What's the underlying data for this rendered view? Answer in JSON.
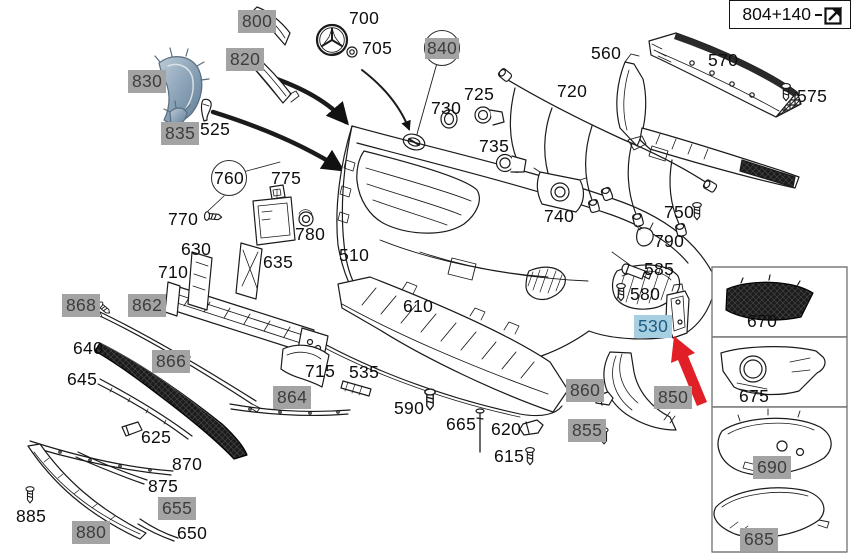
{
  "diagram": {
    "title_ref": "Front bumper exploded parts diagram",
    "ref_box": {
      "label": "804+140",
      "icon": "external-link-icon"
    },
    "selection": {
      "selected_part": "530",
      "annotation": "red-arrow-pointing-to-530"
    },
    "colors": {
      "muted_bg": "#a3a3a3",
      "muted_fg": "#3d3d3d",
      "selected_bg": "#a6cfe2",
      "selected_fg": "#1d5b7f",
      "arrow_red": "#e01f26",
      "line": "#1b1b1b"
    },
    "callouts": [
      {
        "text": "800",
        "style": "muted",
        "x": 238,
        "y": 10
      },
      {
        "text": "820",
        "style": "muted",
        "x": 226,
        "y": 48
      },
      {
        "text": "830",
        "style": "muted",
        "x": 128,
        "y": 70
      },
      {
        "text": "835",
        "style": "muted",
        "x": 161,
        "y": 122
      },
      {
        "text": "525",
        "style": "plain",
        "x": 200,
        "y": 119
      },
      {
        "text": "700",
        "style": "plain",
        "x": 349,
        "y": 8
      },
      {
        "text": "705",
        "style": "plain",
        "x": 362,
        "y": 38
      },
      {
        "text": "840",
        "style": "circle-muted",
        "x": 424,
        "y": 30
      },
      {
        "text": "730",
        "style": "plain",
        "x": 431,
        "y": 98
      },
      {
        "text": "725",
        "style": "plain",
        "x": 464,
        "y": 84
      },
      {
        "text": "735",
        "style": "plain",
        "x": 479,
        "y": 136
      },
      {
        "text": "720",
        "style": "plain",
        "x": 557,
        "y": 81
      },
      {
        "text": "560",
        "style": "plain",
        "x": 591,
        "y": 43
      },
      {
        "text": "570",
        "style": "plain",
        "x": 708,
        "y": 50
      },
      {
        "text": "575",
        "style": "plain",
        "x": 797,
        "y": 86
      },
      {
        "text": "740",
        "style": "plain",
        "x": 544,
        "y": 206
      },
      {
        "text": "750",
        "style": "plain",
        "x": 664,
        "y": 202
      },
      {
        "text": "790",
        "style": "plain",
        "x": 654,
        "y": 231
      },
      {
        "text": "585",
        "style": "plain",
        "x": 644,
        "y": 259
      },
      {
        "text": "580",
        "style": "plain",
        "x": 630,
        "y": 284
      },
      {
        "text": "530",
        "style": "selected",
        "x": 634,
        "y": 315
      },
      {
        "text": "510",
        "style": "plain",
        "x": 339,
        "y": 245
      },
      {
        "text": "610",
        "style": "plain",
        "x": 403,
        "y": 296
      },
      {
        "text": "760",
        "style": "circle",
        "x": 211,
        "y": 160
      },
      {
        "text": "770",
        "style": "plain",
        "x": 168,
        "y": 209
      },
      {
        "text": "775",
        "style": "plain",
        "x": 271,
        "y": 168
      },
      {
        "text": "780",
        "style": "plain",
        "x": 295,
        "y": 224
      },
      {
        "text": "630",
        "style": "plain",
        "x": 181,
        "y": 239
      },
      {
        "text": "635",
        "style": "plain",
        "x": 263,
        "y": 252
      },
      {
        "text": "710",
        "style": "plain",
        "x": 158,
        "y": 262
      },
      {
        "text": "868",
        "style": "muted",
        "x": 62,
        "y": 294
      },
      {
        "text": "862",
        "style": "muted",
        "x": 128,
        "y": 294
      },
      {
        "text": "866",
        "style": "muted",
        "x": 152,
        "y": 350
      },
      {
        "text": "640",
        "style": "plain",
        "x": 73,
        "y": 338
      },
      {
        "text": "645",
        "style": "plain",
        "x": 67,
        "y": 369
      },
      {
        "text": "864",
        "style": "muted",
        "x": 273,
        "y": 386
      },
      {
        "text": "625",
        "style": "plain",
        "x": 141,
        "y": 427
      },
      {
        "text": "870",
        "style": "plain",
        "x": 172,
        "y": 454
      },
      {
        "text": "875",
        "style": "plain",
        "x": 148,
        "y": 476
      },
      {
        "text": "655",
        "style": "muted",
        "x": 158,
        "y": 497
      },
      {
        "text": "885",
        "style": "plain",
        "x": 16,
        "y": 506
      },
      {
        "text": "880",
        "style": "muted",
        "x": 72,
        "y": 521
      },
      {
        "text": "650",
        "style": "plain",
        "x": 177,
        "y": 523
      },
      {
        "text": "715",
        "style": "plain",
        "x": 305,
        "y": 361
      },
      {
        "text": "535",
        "style": "plain",
        "x": 349,
        "y": 362
      },
      {
        "text": "590",
        "style": "plain",
        "x": 394,
        "y": 398
      },
      {
        "text": "665",
        "style": "plain",
        "x": 446,
        "y": 414
      },
      {
        "text": "620",
        "style": "plain",
        "x": 491,
        "y": 419
      },
      {
        "text": "615",
        "style": "plain",
        "x": 494,
        "y": 446
      },
      {
        "text": "860",
        "style": "muted",
        "x": 566,
        "y": 379
      },
      {
        "text": "855",
        "style": "muted",
        "x": 568,
        "y": 419
      },
      {
        "text": "850",
        "style": "muted",
        "x": 654,
        "y": 386
      },
      {
        "text": "670",
        "style": "plain",
        "x": 747,
        "y": 311
      },
      {
        "text": "675",
        "style": "plain",
        "x": 739,
        "y": 386
      },
      {
        "text": "690",
        "style": "muted",
        "x": 753,
        "y": 456
      },
      {
        "text": "685",
        "style": "muted",
        "x": 740,
        "y": 528
      }
    ]
  }
}
